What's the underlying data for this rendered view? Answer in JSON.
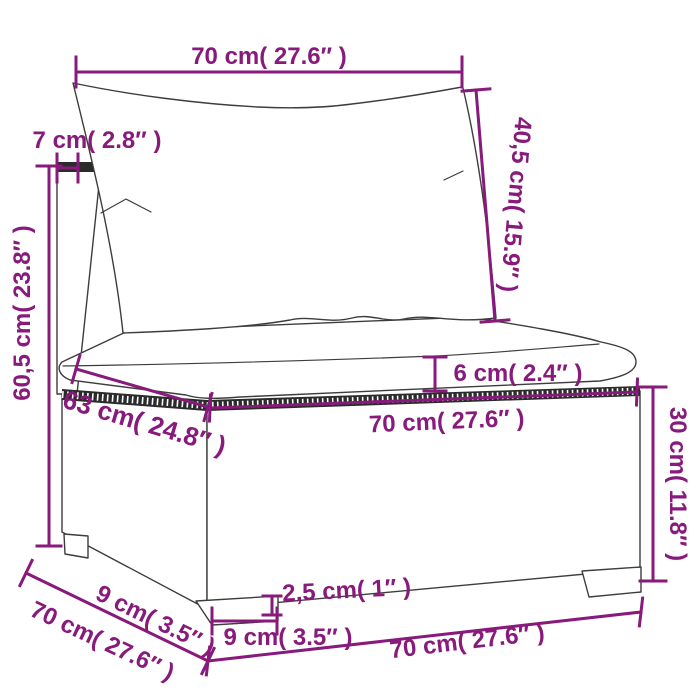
{
  "diagram": {
    "labels": {
      "top_width": "70 cm( 27.6″ )",
      "back_post_depth": "7 cm( 2.8″ )",
      "overall_height": "60,5 cm( 23.8″ )",
      "back_cushion_length": "40,5 cm( 15.9″ )",
      "seat_cushion_thickness": "6 cm( 2.4″ )",
      "seat_depth": "63 cm( 24.8″ )",
      "seat_width": "70 cm( 27.6″ )",
      "base_height": "30 cm( 11.8″ )",
      "foot_inset_side": "9 cm( 3.5″ )",
      "side_depth": "70 cm( 27.6″ )",
      "foot_height": "2,5 cm( 1″ )",
      "foot_width": "9 cm( 3.5″ )",
      "front_width_bottom": "70 cm( 27.6″ )"
    },
    "colors": {
      "dimension_accent": "#871a7b",
      "line_art": "#3d3d3d",
      "background": "#ffffff"
    }
  }
}
